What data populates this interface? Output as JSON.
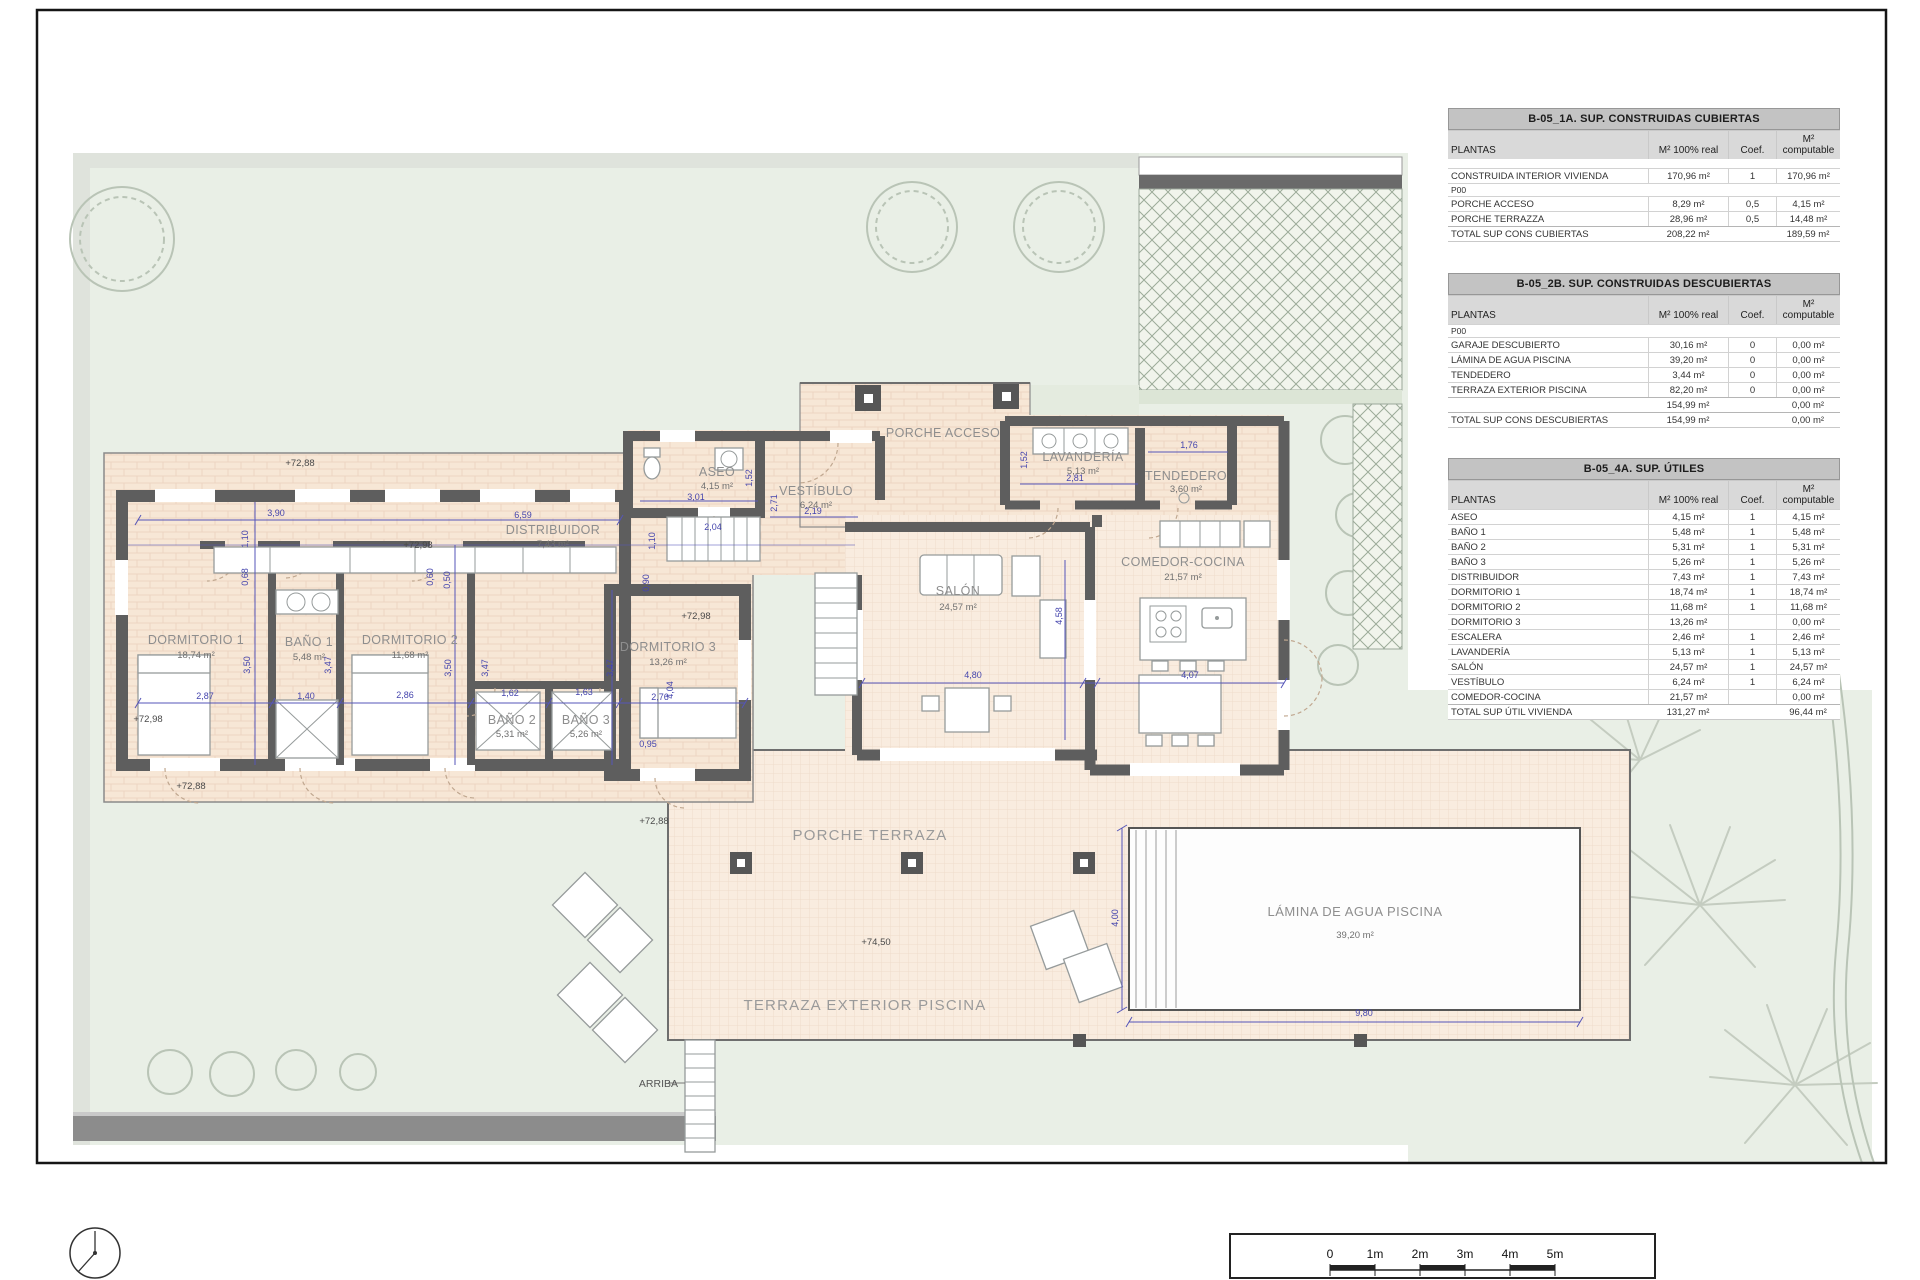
{
  "drawing": {
    "rooms": {
      "dormitorio1": {
        "name": "DORMITORIO 1",
        "area": "18,74 m²"
      },
      "bano1": {
        "name": "BAÑO 1",
        "area": "5,48 m²"
      },
      "dormitorio2": {
        "name": "DORMITORIO 2",
        "area": "11,68 m²"
      },
      "bano2": {
        "name": "BAÑO 2",
        "area": "5,31 m²"
      },
      "bano3": {
        "name": "BAÑO 3",
        "area": "5,26 m²"
      },
      "dormitorio3": {
        "name": "DORMITORIO 3",
        "area": "13,26 m²"
      },
      "distribuidor": {
        "name": "DISTRIBUIDOR",
        "area": "7,43 m²"
      },
      "aseo": {
        "name": "ASEO",
        "area": "4,15 m²"
      },
      "vestibulo": {
        "name": "VESTÍBULO",
        "area": "6,24 m²"
      },
      "lavanderia": {
        "name": "LAVANDERÍA",
        "area": "5,13 m²"
      },
      "lavanderia_dim": "2,81",
      "tendedero": {
        "name": "TENDEDERO",
        "area": "3,60 m²"
      },
      "salon": {
        "name": "SALÓN",
        "area": "24,57 m²"
      },
      "comedor": {
        "name": "COMEDOR-COCINA",
        "area": "21,57 m²"
      },
      "porche_acceso": {
        "name": "PORCHE ACCESO"
      },
      "porche_terraza": {
        "name": "PORCHE TERRAZA"
      },
      "terraza_exterior": {
        "name": "TERRAZA EXTERIOR PISCINA"
      },
      "piscina": {
        "name": "LÁMINA DE AGUA PISCINA",
        "area": "39,20 m²"
      },
      "arriba": {
        "name": "ARRIBA"
      }
    },
    "levels": {
      "l1": "+72,88",
      "l2": "+72,88",
      "l3": "+72,88",
      "l4": "+72,98",
      "l5": "+72,98",
      "l6": "+72,98",
      "l7": "+74,50"
    },
    "dims": {
      "d1": "2,87",
      "d2": "1,40",
      "d3": "2,86",
      "d4": "1,62",
      "d5": "1,63",
      "d6": "2,76",
      "d7": "3,50",
      "d8": "3,47",
      "d9": "3,50",
      "d10": "3,47",
      "d11": "3,47",
      "d12": "4,04",
      "d13": "1,10",
      "d14": "0,68",
      "d15": "3,90",
      "d16": "6,59",
      "d17": "0,50",
      "d18": "3,01",
      "d19": "1,52",
      "d20": "2,04",
      "d21": "1,10",
      "d22": "2,71",
      "d23": "2,19",
      "d24": "1,52",
      "d25": "2,81",
      "d26": "1,76",
      "d27": "4,58",
      "d28": "4,80",
      "d29": "4,07",
      "d30": "0,95",
      "d31": "4,00",
      "d32": "9,80",
      "d33": "0,60",
      "d34": "0,90"
    }
  },
  "tables": [
    {
      "title": "B-05_1A. SUP. CONSTRUIDAS CUBIERTAS",
      "col_headers": [
        "PLANTAS",
        "M² 100% real",
        "Coef.",
        "M² computable"
      ],
      "rows": [
        {
          "type": "spacer",
          "label": ""
        },
        {
          "type": "data",
          "label": "CONSTRUIDA INTERIOR VIVIENDA",
          "real": "170,96 m²",
          "coef": "1",
          "comp": "170,96 m²"
        },
        {
          "type": "section",
          "label": "P00"
        },
        {
          "type": "data",
          "label": "PORCHE ACCESO",
          "real": "8,29 m²",
          "coef": "0,5",
          "comp": "4,15 m²"
        },
        {
          "type": "data",
          "label": "PORCHE TERRAZZA",
          "real": "28,96 m²",
          "coef": "0,5",
          "comp": "14,48 m²"
        },
        {
          "type": "total",
          "label": "TOTAL SUP CONS CUBIERTAS",
          "real": "208,22 m²",
          "coef": "",
          "comp": "189,59 m²"
        }
      ]
    },
    {
      "title": "B-05_2B. SUP. CONSTRUIDAS DESCUBIERTAS",
      "col_headers": [
        "PLANTAS",
        "M² 100% real",
        "Coef.",
        "M² computable"
      ],
      "rows": [
        {
          "type": "section",
          "label": "P00"
        },
        {
          "type": "data",
          "label": "GARAJE DESCUBIERTO",
          "real": "30,16 m²",
          "coef": "0",
          "comp": "0,00 m²"
        },
        {
          "type": "data",
          "label": "LÁMINA DE AGUA PISCINA",
          "real": "39,20 m²",
          "coef": "0",
          "comp": "0,00 m²"
        },
        {
          "type": "data",
          "label": "TENDEDERO",
          "real": "3,44 m²",
          "coef": "0",
          "comp": "0,00 m²"
        },
        {
          "type": "data",
          "label": "TERRAZA EXTERIOR PISCINA",
          "real": "82,20 m²",
          "coef": "0",
          "comp": "0,00 m²"
        },
        {
          "type": "total",
          "label": "",
          "real": "154,99 m²",
          "coef": "",
          "comp": "0,00 m²"
        },
        {
          "type": "total",
          "label": "TOTAL SUP CONS DESCUBIERTAS",
          "real": "154,99 m²",
          "coef": "",
          "comp": "0,00 m²"
        }
      ]
    },
    {
      "title": "B-05_4A. SUP. ÚTILES",
      "col_headers": [
        "PLANTAS",
        "M² 100% real",
        "Coef.",
        "M² computable"
      ],
      "rows": [
        {
          "type": "data",
          "label": "ASEO",
          "real": "4,15 m²",
          "coef": "1",
          "comp": "4,15 m²"
        },
        {
          "type": "data",
          "label": "BAÑO 1",
          "real": "5,48 m²",
          "coef": "1",
          "comp": "5,48 m²"
        },
        {
          "type": "data",
          "label": "BAÑO 2",
          "real": "5,31 m²",
          "coef": "1",
          "comp": "5,31 m²"
        },
        {
          "type": "data",
          "label": "BAÑO 3",
          "real": "5,26 m²",
          "coef": "1",
          "comp": "5,26 m²"
        },
        {
          "type": "data",
          "label": "DISTRIBUIDOR",
          "real": "7,43 m²",
          "coef": "1",
          "comp": "7,43 m²"
        },
        {
          "type": "data",
          "label": "DORMITORIO 1",
          "real": "18,74 m²",
          "coef": "1",
          "comp": "18,74 m²"
        },
        {
          "type": "data",
          "label": "DORMITORIO 2",
          "real": "11,68 m²",
          "coef": "1",
          "comp": "11,68 m²"
        },
        {
          "type": "data",
          "label": "DORMITORIO 3",
          "real": "13,26 m²",
          "coef": "",
          "comp": "0,00 m²"
        },
        {
          "type": "data",
          "label": "ESCALERA",
          "real": "2,46 m²",
          "coef": "1",
          "comp": "2,46 m²"
        },
        {
          "type": "data",
          "label": "LAVANDERÍA",
          "real": "5,13 m²",
          "coef": "1",
          "comp": "5,13 m²"
        },
        {
          "type": "data",
          "label": "SALÓN",
          "real": "24,57 m²",
          "coef": "1",
          "comp": "24,57 m²"
        },
        {
          "type": "data",
          "label": "VESTÍBULO",
          "real": "6,24 m²",
          "coef": "1",
          "comp": "6,24 m²"
        },
        {
          "type": "data",
          "label": "COMEDOR-COCINA",
          "real": "21,57 m²",
          "coef": "",
          "comp": "0,00 m²"
        },
        {
          "type": "total",
          "label": "TOTAL SUP ÚTIL VIVIENDA",
          "real": "131,27 m²",
          "coef": "",
          "comp": "96,44 m²"
        }
      ]
    }
  ],
  "scalebar": {
    "labels": [
      "0",
      "1m",
      "2m",
      "3m",
      "4m",
      "5m"
    ]
  },
  "colors": {
    "wall": "#5e5e5e",
    "dim_blue": "#4545ad",
    "label_gray": "#8e8e8e",
    "garden_green": "#e9efe6",
    "floor_peach": "#f7e7d6",
    "table_title_bg": "#c3c3c3",
    "table_header_bg": "#d9d9d9"
  }
}
